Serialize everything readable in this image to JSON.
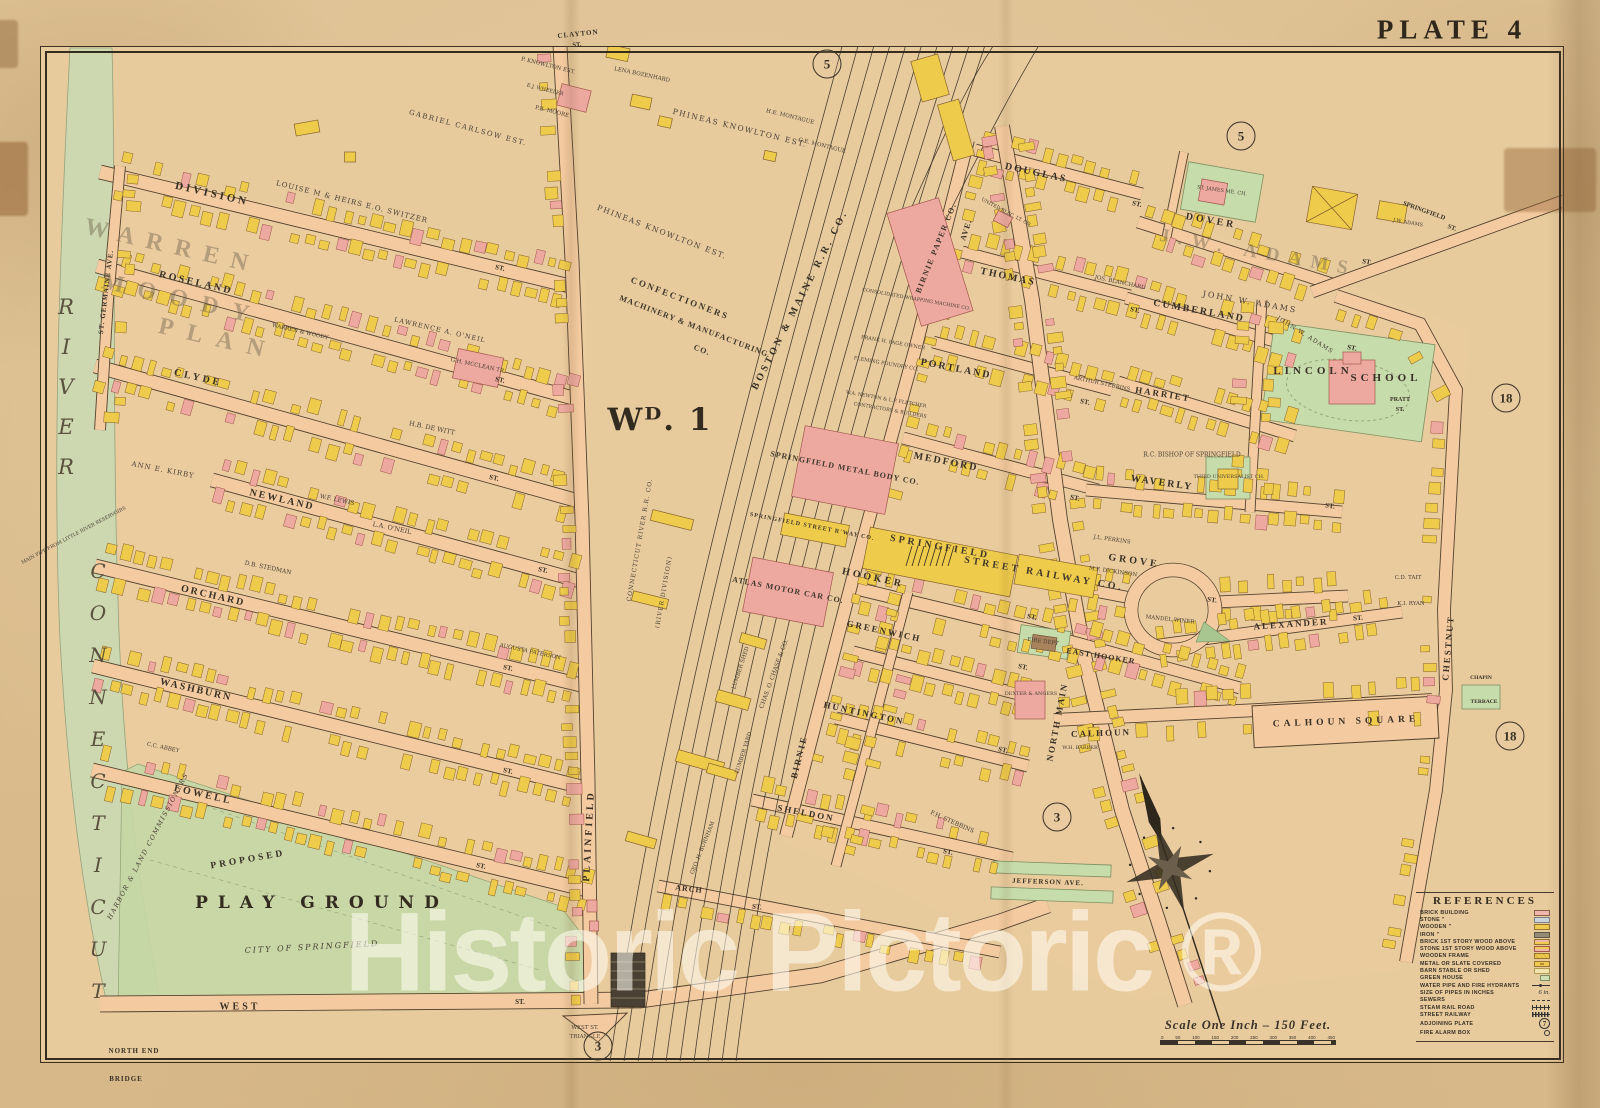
{
  "plate": {
    "title": "PLATE 4",
    "ward_label": "Wᴰ. 1"
  },
  "watermark": "Historic Pictoric ®",
  "palette": {
    "paper": "#e7cb9d",
    "street": "#f4cba0",
    "river": "#cdd7b0",
    "park": "#c6d7a5",
    "building_wood": "#efcb4b",
    "building_brick": "#eda9a0",
    "ink": "#3a3126"
  },
  "scale": {
    "text": "Scale One Inch – 150 Feet.",
    "ticks": [
      "0",
      "50",
      "100",
      "150",
      "200",
      "250",
      "300",
      "350",
      "400",
      "450"
    ]
  },
  "references": {
    "title": "REFERENCES",
    "items": [
      {
        "label": "BRICK BUILDING",
        "kind": "brick"
      },
      {
        "label": "STONE ”",
        "kind": "stone"
      },
      {
        "label": "WOODEN ”",
        "kind": "wood"
      },
      {
        "label": "IRON ”",
        "kind": "iron"
      },
      {
        "label": "BRICK 1ST STORY WOOD ABOVE",
        "kind": "brickwood"
      },
      {
        "label": "STONE 1ST STORY WOOD ABOVE",
        "kind": "stonewood"
      },
      {
        "label": "WOODEN FRAME",
        "kind": "frame"
      },
      {
        "label": "METAL OR SLATE COVERED",
        "kind": "metal"
      },
      {
        "label": "BARN STABLE OR SHED",
        "kind": "barn"
      },
      {
        "label": "GREEN HOUSE",
        "kind": "greenhouse"
      },
      {
        "label": "WATER PIPE AND FIRE HYDRANTS",
        "kind": "water"
      },
      {
        "label": "SIZE OF PIPES IN INCHES",
        "kind": "text",
        "value": "6 in."
      },
      {
        "label": "SEWERS",
        "kind": "sewer"
      },
      {
        "label": "STEAM RAIL ROAD",
        "kind": "rail"
      },
      {
        "label": "STREET RAILWAY",
        "kind": "srail"
      },
      {
        "label": "ADJOINING PLATE",
        "kind": "plate",
        "value": "7"
      },
      {
        "label": "FIRE ALARM BOX",
        "kind": "alarm"
      }
    ]
  },
  "plate_circles": [
    {
      "n": "5",
      "x": 827,
      "y": 64
    },
    {
      "n": "5",
      "x": 1241,
      "y": 136
    },
    {
      "n": "18",
      "x": 1506,
      "y": 398
    },
    {
      "n": "18",
      "x": 1510,
      "y": 736
    },
    {
      "n": "3",
      "x": 1057,
      "y": 817
    },
    {
      "n": "3",
      "x": 598,
      "y": 1046
    }
  ],
  "map_labels": [
    {
      "t": "CLAYTON",
      "x": 578,
      "y": 34,
      "r": -6,
      "s": 7,
      "l": 1,
      "c": "st"
    },
    {
      "t": "ST.",
      "x": 577,
      "y": 45,
      "r": -6,
      "s": 6.5,
      "c": "st"
    },
    {
      "t": "P. KNOWLTON EST.",
      "x": 548,
      "y": 66,
      "r": 14,
      "s": 5.5,
      "c": "own"
    },
    {
      "t": "P.B. MOORE",
      "x": 552,
      "y": 112,
      "r": 14,
      "s": 5.5,
      "c": "own"
    },
    {
      "t": "E.J. WHEELER",
      "x": 545,
      "y": 90,
      "r": 14,
      "s": 5,
      "c": "own"
    },
    {
      "t": "LENA BOZENHARD",
      "x": 642,
      "y": 75,
      "r": 12,
      "s": 5.5,
      "c": "own"
    },
    {
      "t": "GABRIEL CARLSOW EST.",
      "x": 468,
      "y": 128,
      "r": 15,
      "s": 7,
      "l": 1.5,
      "c": "own"
    },
    {
      "t": "LOUISE M & HEIRS E.O. SWITZER",
      "x": 352,
      "y": 202,
      "r": 14,
      "s": 7,
      "l": 1,
      "c": "own"
    },
    {
      "t": "PHINEAS KNOWLTON EST.",
      "x": 740,
      "y": 128,
      "r": 14,
      "s": 7.5,
      "l": 1.5,
      "c": "own"
    },
    {
      "t": "PHINEAS KNOWLTON EST.",
      "x": 662,
      "y": 232,
      "r": 21,
      "s": 7.5,
      "l": 1.5,
      "c": "own"
    },
    {
      "t": "H.E. MONTAGUE",
      "x": 790,
      "y": 117,
      "r": 14,
      "s": 5.5,
      "c": "own"
    },
    {
      "t": "G.E. MONTAGUE",
      "x": 822,
      "y": 146,
      "r": 14,
      "s": 5.5,
      "c": "own"
    },
    {
      "t": "DIVISION",
      "x": 212,
      "y": 194,
      "r": 13,
      "s": 11,
      "l": 3,
      "c": "st"
    },
    {
      "t": "ST.",
      "x": 500,
      "y": 268,
      "r": 13,
      "s": 7,
      "c": "st"
    },
    {
      "t": "ROSELAND",
      "x": 196,
      "y": 283,
      "r": 13,
      "s": 10,
      "l": 2.5,
      "c": "st"
    },
    {
      "t": "ST.",
      "x": 500,
      "y": 380,
      "r": 13,
      "s": 7,
      "c": "st"
    },
    {
      "t": "CLYDE",
      "x": 198,
      "y": 378,
      "r": 13,
      "s": 10,
      "l": 3,
      "c": "st"
    },
    {
      "t": "ST.",
      "x": 494,
      "y": 478,
      "r": 13,
      "s": 7,
      "c": "st"
    },
    {
      "t": "NEWLAND",
      "x": 282,
      "y": 500,
      "r": 13,
      "s": 10,
      "l": 2,
      "c": "st"
    },
    {
      "t": "ST.",
      "x": 543,
      "y": 570,
      "r": 12,
      "s": 7,
      "c": "st"
    },
    {
      "t": "ORCHARD",
      "x": 213,
      "y": 596,
      "r": 13,
      "s": 10,
      "l": 2,
      "c": "st"
    },
    {
      "t": "ST.",
      "x": 508,
      "y": 668,
      "r": 12,
      "s": 7,
      "c": "st"
    },
    {
      "t": "WASHBURN",
      "x": 196,
      "y": 690,
      "r": 13,
      "s": 10,
      "l": 2,
      "c": "st"
    },
    {
      "t": "ST.",
      "x": 508,
      "y": 771,
      "r": 12,
      "s": 7,
      "c": "st"
    },
    {
      "t": "LOWELL",
      "x": 203,
      "y": 795,
      "r": 13,
      "s": 10,
      "l": 2.5,
      "c": "st"
    },
    {
      "t": "ST.",
      "x": 481,
      "y": 866,
      "r": 12,
      "s": 7,
      "c": "st"
    },
    {
      "t": "WEST",
      "x": 240,
      "y": 1007,
      "r": 0,
      "s": 10,
      "l": 3,
      "c": "st"
    },
    {
      "t": "ST.",
      "x": 520,
      "y": 1002,
      "r": 0,
      "s": 7,
      "c": "st"
    },
    {
      "t": "ST. GERMAINE AVE.",
      "x": 106,
      "y": 292,
      "r": -83,
      "s": 7,
      "l": 1,
      "c": "st"
    },
    {
      "t": "WARREN",
      "x": 172,
      "y": 247,
      "r": 13,
      "s": 24,
      "l": 12,
      "c": "plan"
    },
    {
      "t": "MOODY",
      "x": 182,
      "y": 300,
      "r": 13,
      "s": 24,
      "l": 14,
      "c": "plan"
    },
    {
      "t": "PLAN",
      "x": 218,
      "y": 340,
      "r": 13,
      "s": 24,
      "l": 14,
      "c": "plan"
    },
    {
      "t": "WARREN & WOODY",
      "x": 300,
      "y": 332,
      "r": 13,
      "s": 5.5,
      "c": "own"
    },
    {
      "t": "LAWRENCE A. O'NEIL",
      "x": 440,
      "y": 330,
      "r": 13,
      "s": 6.5,
      "l": 1,
      "c": "own"
    },
    {
      "t": "ANN E. KIRBY",
      "x": 163,
      "y": 470,
      "r": 11,
      "s": 7,
      "l": 1,
      "c": "own"
    },
    {
      "t": "W.F. LEWIS",
      "x": 337,
      "y": 500,
      "r": 12,
      "s": 6,
      "c": "own"
    },
    {
      "t": "H.B. DE WITT",
      "x": 432,
      "y": 428,
      "r": 12,
      "s": 6.5,
      "c": "own"
    },
    {
      "t": "L.A. O'NEIL",
      "x": 392,
      "y": 528,
      "r": 12,
      "s": 6.5,
      "c": "own"
    },
    {
      "t": "D.B. STEDMAN",
      "x": 268,
      "y": 568,
      "r": 12,
      "s": 6,
      "c": "own"
    },
    {
      "t": "G.H. MCCLEAN TR.",
      "x": 478,
      "y": 366,
      "r": 12,
      "s": 5.5,
      "c": "own"
    },
    {
      "t": "AUGUSTA PATERSON",
      "x": 530,
      "y": 652,
      "r": 12,
      "s": 5.5,
      "c": "own"
    },
    {
      "t": "C.C. ABBEY",
      "x": 163,
      "y": 748,
      "r": 12,
      "s": 5.5,
      "c": "own"
    },
    {
      "t": "PROPOSED",
      "x": 248,
      "y": 860,
      "r": -10,
      "s": 9.5,
      "l": 3,
      "c": "st"
    },
    {
      "t": "PLAY GROUND",
      "x": 322,
      "y": 903,
      "r": 0,
      "s": 17,
      "l": 10,
      "c": "big"
    },
    {
      "t": "CITY OF SPRINGFIELD",
      "x": 312,
      "y": 947,
      "r": -3,
      "s": 8,
      "l": 2,
      "c": "ital"
    },
    {
      "t": "HARBOR & LAND COMMISSIONERS",
      "x": 148,
      "y": 846,
      "r": -62,
      "s": 6.5,
      "l": 1.5,
      "c": "ital"
    },
    {
      "t": "MAIN PIPE FROM LITTLE RIVER RESERVOIRS",
      "x": 74,
      "y": 536,
      "r": -28,
      "s": 4.8,
      "c": "own"
    },
    {
      "t": "NORTH END",
      "x": 134,
      "y": 1051,
      "r": 0,
      "s": 7,
      "l": 1,
      "c": "st"
    },
    {
      "t": "BRIDGE",
      "x": 126,
      "y": 1079,
      "r": 0,
      "s": 7,
      "l": 1,
      "c": "st"
    },
    {
      "t": "WEST ST.",
      "x": 585,
      "y": 1028,
      "r": 0,
      "s": 5.5,
      "c": "own"
    },
    {
      "t": "TRIANGLE",
      "x": 585,
      "y": 1037,
      "r": 0,
      "s": 5.5,
      "c": "own"
    },
    {
      "t": "PLAINFIELD",
      "x": 589,
      "y": 836,
      "r": -87,
      "s": 10,
      "l": 3,
      "c": "st"
    },
    {
      "t": "Wᴰ. 1",
      "x": 660,
      "y": 420,
      "r": 0,
      "s": 31,
      "l": 2,
      "c": "big"
    },
    {
      "t": "CONFECTIONERS",
      "x": 680,
      "y": 298,
      "r": 21,
      "s": 9,
      "l": 2,
      "c": "comp"
    },
    {
      "t": "MACHINERY & MANUFACTURING",
      "x": 694,
      "y": 326,
      "r": 21,
      "s": 8,
      "l": 1,
      "c": "comp"
    },
    {
      "t": "CO.",
      "x": 702,
      "y": 350,
      "r": 21,
      "s": 8,
      "l": 1,
      "c": "comp"
    },
    {
      "t": "BOSTON & MAINE R.R. CO.",
      "x": 800,
      "y": 300,
      "r": -63,
      "s": 10,
      "l": 3,
      "c": "st"
    },
    {
      "t": "CONNECTICUT RIVER R.R. CO.",
      "x": 640,
      "y": 540,
      "r": -80,
      "s": 6,
      "l": 1,
      "c": "own"
    },
    {
      "t": "(RIVER DIVISION)",
      "x": 664,
      "y": 592,
      "r": -80,
      "s": 6,
      "l": 1,
      "c": "own"
    },
    {
      "t": "BIRNIE PAPER CO.",
      "x": 936,
      "y": 248,
      "r": -68,
      "s": 8,
      "l": 1.5,
      "c": "comp"
    },
    {
      "t": "AVE.",
      "x": 966,
      "y": 230,
      "r": -72,
      "s": 8,
      "l": 1,
      "c": "st"
    },
    {
      "t": "BIRNIE",
      "x": 799,
      "y": 757,
      "r": -76,
      "s": 9,
      "l": 2,
      "c": "st"
    },
    {
      "t": "CONSOLIDATED WRAPPING MACHINE CO.",
      "x": 916,
      "y": 300,
      "r": 10,
      "s": 4.8,
      "c": "own"
    },
    {
      "t": "FRANK H. PAGE OWNER",
      "x": 893,
      "y": 343,
      "r": 10,
      "s": 5,
      "c": "own"
    },
    {
      "t": "FLEMING FOUNDRY CO.",
      "x": 886,
      "y": 364,
      "r": 10,
      "s": 5,
      "c": "own"
    },
    {
      "t": "W.A. NEWTON & L.P. FLETCHER",
      "x": 886,
      "y": 400,
      "r": 10,
      "s": 4.8,
      "c": "own"
    },
    {
      "t": "CONTRACTORS & BUILDERS",
      "x": 890,
      "y": 411,
      "r": 10,
      "s": 4.8,
      "c": "own"
    },
    {
      "t": "SPRINGFIELD METAL BODY CO.",
      "x": 845,
      "y": 468,
      "r": 11,
      "s": 8,
      "l": 1,
      "c": "comp"
    },
    {
      "t": "SPRINGFIELD STREET R'WAY CO.",
      "x": 812,
      "y": 527,
      "r": 11,
      "s": 6,
      "c": "comp"
    },
    {
      "t": "SPRINGFIELD",
      "x": 940,
      "y": 547,
      "r": 10,
      "s": 10,
      "l": 3,
      "c": "comp"
    },
    {
      "t": "STREET RAILWAY CO.",
      "x": 1044,
      "y": 574,
      "r": 10,
      "s": 10,
      "l": 3,
      "c": "comp"
    },
    {
      "t": "ATLAS MOTOR CAR CO.",
      "x": 788,
      "y": 590,
      "r": 11,
      "s": 8,
      "l": 1,
      "c": "comp"
    },
    {
      "t": "HOOKER",
      "x": 873,
      "y": 578,
      "r": 12,
      "s": 10,
      "l": 3,
      "c": "st"
    },
    {
      "t": "ST.",
      "x": 1032,
      "y": 617,
      "r": 12,
      "s": 7,
      "c": "st"
    },
    {
      "t": "GREENWICH",
      "x": 884,
      "y": 631,
      "r": 12,
      "s": 9,
      "l": 2,
      "c": "st"
    },
    {
      "t": "ST.",
      "x": 1023,
      "y": 667,
      "r": 12,
      "s": 7,
      "c": "st"
    },
    {
      "t": "HUNTINGTON",
      "x": 864,
      "y": 713,
      "r": 12,
      "s": 9,
      "l": 2,
      "c": "st"
    },
    {
      "t": "ST.",
      "x": 1003,
      "y": 750,
      "r": 12,
      "s": 7,
      "c": "st"
    },
    {
      "t": "SHELDON",
      "x": 806,
      "y": 813,
      "r": 11,
      "s": 9,
      "l": 2,
      "c": "st"
    },
    {
      "t": "ST.",
      "x": 948,
      "y": 852,
      "r": 11,
      "s": 7,
      "c": "st"
    },
    {
      "t": "ARCH",
      "x": 689,
      "y": 889,
      "r": 6,
      "s": 8,
      "l": 1,
      "c": "st"
    },
    {
      "t": "ST.",
      "x": 757,
      "y": 907,
      "r": 6,
      "s": 7,
      "c": "st"
    },
    {
      "t": "GEO. H. BURNHAM",
      "x": 703,
      "y": 848,
      "r": -68,
      "s": 5.5,
      "c": "own"
    },
    {
      "t": "CHAS. O. CHASE & CO.",
      "x": 774,
      "y": 674,
      "r": -70,
      "s": 6,
      "c": "own"
    },
    {
      "t": "LUMBER SHED",
      "x": 741,
      "y": 668,
      "r": -72,
      "s": 5.5,
      "c": "own"
    },
    {
      "t": "LUMBER YARD",
      "x": 744,
      "y": 753,
      "r": -72,
      "s": 5.5,
      "c": "own"
    },
    {
      "t": "F.H. STEBBINS",
      "x": 952,
      "y": 822,
      "r": 24,
      "s": 6,
      "c": "own"
    },
    {
      "t": "DOUGLAS",
      "x": 1036,
      "y": 173,
      "r": 12,
      "s": 10,
      "l": 2,
      "c": "st"
    },
    {
      "t": "ST.",
      "x": 1137,
      "y": 204,
      "r": 12,
      "s": 7,
      "c": "st"
    },
    {
      "t": "THOMAS",
      "x": 1008,
      "y": 277,
      "r": 12,
      "s": 10,
      "l": 2,
      "c": "st"
    },
    {
      "t": "ST.",
      "x": 1135,
      "y": 310,
      "r": 12,
      "s": 7,
      "c": "st"
    },
    {
      "t": "PORTLAND",
      "x": 956,
      "y": 369,
      "r": 11,
      "s": 10,
      "l": 2,
      "c": "st"
    },
    {
      "t": "ST.",
      "x": 1085,
      "y": 402,
      "r": 11,
      "s": 7,
      "c": "st"
    },
    {
      "t": "MEDFORD",
      "x": 946,
      "y": 462,
      "r": 11,
      "s": 10,
      "l": 2,
      "c": "st"
    },
    {
      "t": "ST.",
      "x": 1075,
      "y": 498,
      "r": 11,
      "s": 7,
      "c": "st"
    },
    {
      "t": "UNITED ELEC. LT. CO.",
      "x": 1006,
      "y": 213,
      "r": 28,
      "s": 4.8,
      "c": "own"
    },
    {
      "t": "JOS. BLANCHARD",
      "x": 1120,
      "y": 283,
      "r": 12,
      "s": 5.5,
      "c": "own"
    },
    {
      "t": "ARTHUR STEBBINS",
      "x": 1102,
      "y": 384,
      "r": 12,
      "s": 5.5,
      "c": "own"
    },
    {
      "t": "NORTH MAIN",
      "x": 1057,
      "y": 722,
      "r": -79,
      "s": 9,
      "l": 2,
      "c": "st"
    },
    {
      "t": "DOVER",
      "x": 1211,
      "y": 221,
      "r": 10,
      "s": 10,
      "l": 3,
      "c": "st"
    },
    {
      "t": "ST.",
      "x": 1367,
      "y": 262,
      "r": 10,
      "s": 7,
      "c": "st"
    },
    {
      "t": "CUMBERLAND",
      "x": 1199,
      "y": 311,
      "r": 10,
      "s": 10,
      "l": 2,
      "c": "st"
    },
    {
      "t": "ST.",
      "x": 1352,
      "y": 348,
      "r": 10,
      "s": 7,
      "c": "st"
    },
    {
      "t": "HARRIET",
      "x": 1163,
      "y": 394,
      "r": 9,
      "s": 9,
      "l": 2,
      "c": "st"
    },
    {
      "t": "WAVERLY",
      "x": 1162,
      "y": 483,
      "r": 8,
      "s": 10,
      "l": 2,
      "c": "st"
    },
    {
      "t": "ST.",
      "x": 1330,
      "y": 506,
      "r": 8,
      "s": 7,
      "c": "st"
    },
    {
      "t": "GROVE",
      "x": 1134,
      "y": 561,
      "r": 8,
      "s": 10,
      "l": 3,
      "c": "st"
    },
    {
      "t": "ST.",
      "x": 1212,
      "y": 600,
      "r": 8,
      "s": 7,
      "c": "st"
    },
    {
      "t": "ALEXANDER",
      "x": 1291,
      "y": 624,
      "r": -4,
      "s": 9,
      "l": 2,
      "c": "st"
    },
    {
      "t": "ST.",
      "x": 1358,
      "y": 618,
      "r": -4,
      "s": 7,
      "c": "st"
    },
    {
      "t": "EAST HOOKER",
      "x": 1101,
      "y": 656,
      "r": 9,
      "s": 8,
      "l": 1,
      "c": "st"
    },
    {
      "t": "CALHOUN",
      "x": 1101,
      "y": 733,
      "r": -2,
      "s": 9,
      "l": 2,
      "c": "st"
    },
    {
      "t": "CALHOUN SQUARE",
      "x": 1346,
      "y": 722,
      "r": -2,
      "s": 9.5,
      "l": 4,
      "c": "st"
    },
    {
      "t": "CHESTNUT",
      "x": 1448,
      "y": 648,
      "r": -85,
      "s": 9,
      "l": 2,
      "c": "st"
    },
    {
      "t": "PRATT",
      "x": 1400,
      "y": 400,
      "r": 0,
      "s": 6,
      "c": "st"
    },
    {
      "t": "ST.",
      "x": 1400,
      "y": 410,
      "r": 0,
      "s": 6,
      "c": "st"
    },
    {
      "t": "CHAPIN",
      "x": 1481,
      "y": 678,
      "r": 0,
      "s": 5.5,
      "c": "st"
    },
    {
      "t": "TERRACE",
      "x": 1484,
      "y": 702,
      "r": 0,
      "s": 5.5,
      "c": "st"
    },
    {
      "t": "SPRINGFIELD",
      "x": 1424,
      "y": 211,
      "r": 20,
      "s": 6.5,
      "c": "st"
    },
    {
      "t": "ST.",
      "x": 1452,
      "y": 228,
      "r": 20,
      "s": 6.5,
      "c": "st"
    },
    {
      "t": "J.W. ADAMS",
      "x": 1258,
      "y": 253,
      "r": 10,
      "s": 19,
      "l": 9,
      "c": "plan"
    },
    {
      "t": "JOHN W. ADAMS",
      "x": 1250,
      "y": 302,
      "r": 10,
      "s": 8,
      "l": 2,
      "c": "own"
    },
    {
      "t": "JOHN W. ADAMS",
      "x": 1305,
      "y": 335,
      "r": 32,
      "s": 6,
      "l": 1,
      "c": "own"
    },
    {
      "t": "J.W. ADAMS",
      "x": 1408,
      "y": 223,
      "r": 10,
      "s": 5,
      "c": "own"
    },
    {
      "t": "ST. JAMES ME. CH.",
      "x": 1222,
      "y": 191,
      "r": 8,
      "s": 5,
      "c": "own"
    },
    {
      "t": "LINCOLN",
      "x": 1313,
      "y": 371,
      "r": 0,
      "s": 11,
      "l": 4,
      "c": "st"
    },
    {
      "t": "SCHOOL",
      "x": 1386,
      "y": 378,
      "r": 0,
      "s": 11,
      "l": 4,
      "c": "st"
    },
    {
      "t": "R.C. BISHOP OF SPRINGFIELD",
      "x": 1192,
      "y": 455,
      "r": 0,
      "s": 6,
      "c": "own"
    },
    {
      "t": "THIRD UNIVERSALIST CH.",
      "x": 1229,
      "y": 477,
      "r": 0,
      "s": 5,
      "c": "own"
    },
    {
      "t": "FIRE DEPT",
      "x": 1043,
      "y": 642,
      "r": 8,
      "s": 5.5,
      "c": "own"
    },
    {
      "t": "DEXTER & ANGERS",
      "x": 1031,
      "y": 694,
      "r": 0,
      "s": 5,
      "c": "own"
    },
    {
      "t": "MANDEL WINER",
      "x": 1170,
      "y": 620,
      "r": 6,
      "s": 5.5,
      "c": "own"
    },
    {
      "t": "M.F. DICKINSON",
      "x": 1113,
      "y": 572,
      "r": 8,
      "s": 5.5,
      "c": "own"
    },
    {
      "t": "J.L. PERKINS",
      "x": 1112,
      "y": 540,
      "r": 8,
      "s": 5.5,
      "c": "own"
    },
    {
      "t": "C.D. TAIT",
      "x": 1408,
      "y": 578,
      "r": 0,
      "s": 5.5,
      "c": "own"
    },
    {
      "t": "K.I. RYAN",
      "x": 1411,
      "y": 604,
      "r": 0,
      "s": 5.5,
      "c": "own"
    },
    {
      "t": "W.H. BARBER",
      "x": 1080,
      "y": 748,
      "r": 0,
      "s": 5,
      "c": "own"
    },
    {
      "t": "JEFFERSON AVE.",
      "x": 1048,
      "y": 882,
      "r": 2,
      "s": 7,
      "l": 1,
      "c": "st"
    },
    {
      "t": "RIVER",
      "x": 66,
      "y": 395,
      "r": 0,
      "s": 21,
      "l": 16,
      "c": "vert"
    },
    {
      "t": "CONNECTICUT",
      "x": 98,
      "y": 790,
      "r": 0,
      "s": 20,
      "l": 18,
      "c": "vert"
    }
  ]
}
